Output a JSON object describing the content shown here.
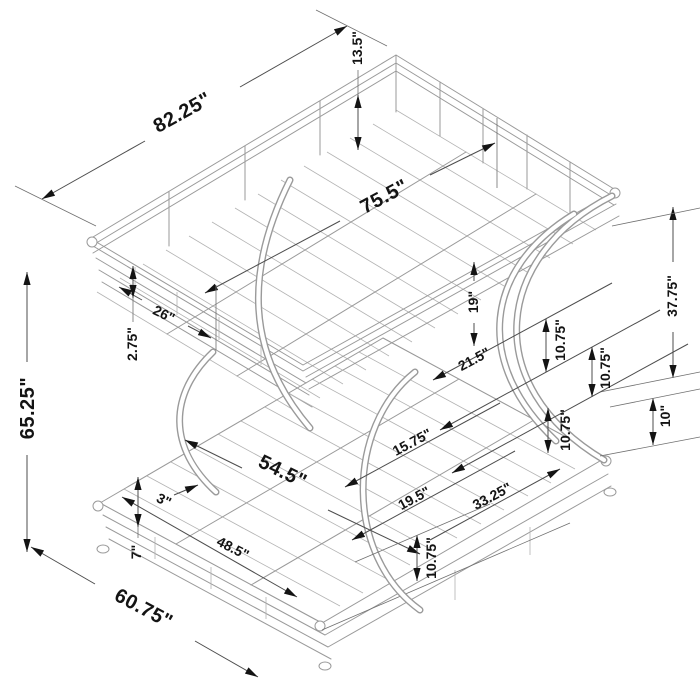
{
  "diagram": {
    "subject": "metal-bunk-bed-dimension-drawing",
    "unit": "inches",
    "colors": {
      "background": "#ffffff",
      "line": "#9a9a9a",
      "dimension_line": "#4d4d4d",
      "label": "#141414"
    },
    "dimensions": [
      {
        "id": "overall-length",
        "label": "82.25\""
      },
      {
        "id": "guardrail-height",
        "label": "13.5\""
      },
      {
        "id": "upper-sleep-length",
        "label": "75.5\""
      },
      {
        "id": "upper-bunk-height",
        "label": "37.75\""
      },
      {
        "id": "upper-side-rail-height",
        "label": "19\""
      },
      {
        "id": "upper-arc-gap-1",
        "label": "10.75\""
      },
      {
        "id": "upper-arc-gap-2",
        "label": "10.75\""
      },
      {
        "id": "upper-rail-span",
        "label": "21.5\""
      },
      {
        "id": "right-base-height",
        "label": "10\""
      },
      {
        "id": "arc-rung-span-1",
        "label": "15.75\""
      },
      {
        "id": "arc-rung-span-2",
        "label": "19.5\""
      },
      {
        "id": "lower-side-span",
        "label": "33.25\""
      },
      {
        "id": "lower-right-rail-gap",
        "label": "10.75\""
      },
      {
        "id": "lower-sleep-width",
        "label": "54.5\""
      },
      {
        "id": "upper-panel-length",
        "label": "26\""
      },
      {
        "id": "rail-thickness",
        "label": "2.75\""
      },
      {
        "id": "overall-height",
        "label": "65.25\""
      },
      {
        "id": "slat-spacing",
        "label": "3\""
      },
      {
        "id": "lower-front-rail-length",
        "label": "48.5\""
      },
      {
        "id": "lower-rail-height",
        "label": "7\""
      },
      {
        "id": "lower-front-clearance",
        "label": "10.75\""
      },
      {
        "id": "overall-width",
        "label": "60.75\""
      }
    ]
  }
}
